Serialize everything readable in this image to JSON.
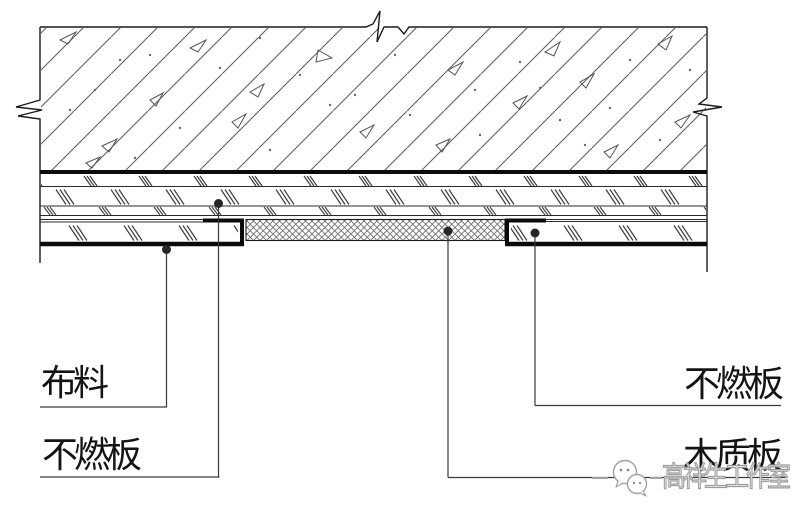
{
  "drawing": {
    "type": "ceiling-construction-detail-section",
    "labels": {
      "fabric": "布料",
      "non_combustible_board_left": "不燃板",
      "non_combustible_board_right": "不燃板",
      "wood_board": "木质板"
    },
    "watermark": {
      "text": "高祥生工作室",
      "logo": "wechat-bubbles"
    },
    "colors": {
      "ink": "#141414",
      "thick_line": "#0b0b0b",
      "hatch": "#5a5a5a",
      "slash_mark": "#3e3e3e",
      "mesh": "#6a6a6a",
      "watermark": "#9c9c9c"
    }
  }
}
